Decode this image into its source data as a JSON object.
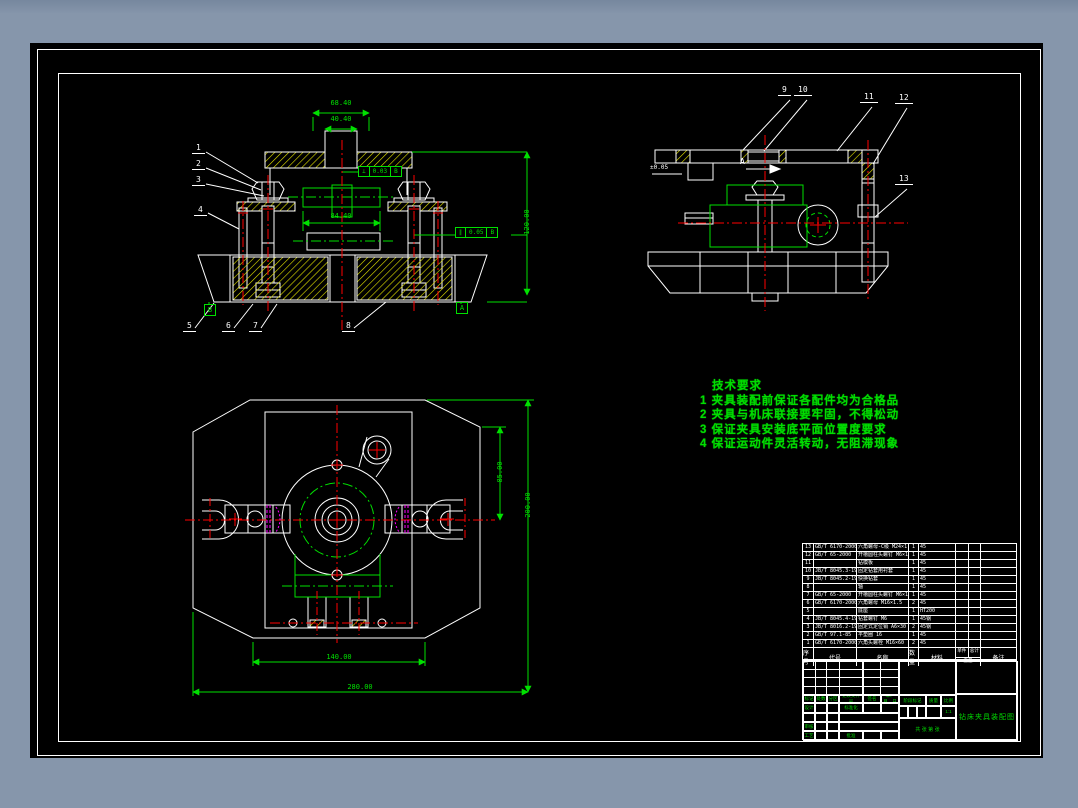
{
  "colors": {
    "background": "#8696ab",
    "paper": "#000000",
    "lines": "#ffffff",
    "dimensions": "#00e000",
    "centerlines": "#ff0000",
    "hatching": "#e6e600",
    "details": "#ff00ff"
  },
  "views": {
    "front": {
      "labels": [
        "1",
        "2",
        "3",
        "4",
        "5",
        "6",
        "7",
        "8"
      ],
      "dims": {
        "top_outer": "68.40",
        "top_inner": "40.40",
        "middle": "84.40",
        "right": "120.00"
      },
      "fcf1": {
        "symbol": "⊥",
        "value": "0.03",
        "datum": "B"
      },
      "fcf2": {
        "symbol": "∥",
        "value": "0.05",
        "datum": "B"
      },
      "datum_left": "B",
      "datum_right": "A"
    },
    "side": {
      "labels": [
        "9",
        "10",
        "11",
        "12",
        "13"
      ],
      "note": "±0.05",
      "section_arrow": "A"
    },
    "plan": {
      "dims": {
        "bottom_inner": "140.00",
        "bottom_outer": "280.00",
        "right_small": "85.00",
        "right_tall": "200.00"
      }
    }
  },
  "tech_req": {
    "title": "技术要求",
    "items": [
      "1 夹具装配前保证各配件均为合格品",
      "2 夹具与机床联接要牢固，不得松动",
      "3 保证夹具安装底平面位置度要求",
      "4 保证运动件灵活转动，无阻滞现象"
    ]
  },
  "bom": {
    "headers": {
      "no": "序号",
      "code": "代号",
      "name": "名称",
      "qty": "数量",
      "material": "材料",
      "unit": "单件",
      "total": "总计",
      "weight": "重量",
      "remark": "备注"
    },
    "rows": [
      [
        "13",
        "GB/T 6170-2000",
        "六角螺母-C级 M24×1.5",
        "1",
        "45",
        "",
        "",
        ""
      ],
      [
        "12",
        "GB/T 65-2000",
        "开槽圆柱头螺钉 M6×16",
        "1",
        "45",
        "",
        "",
        ""
      ],
      [
        "11",
        "",
        "钻模板",
        "1",
        "45",
        "",
        "",
        ""
      ],
      [
        "10",
        "JB/T 8045.3-1999",
        "固定钻套用衬套",
        "1",
        "45",
        "",
        "",
        ""
      ],
      [
        "9",
        "JB/T 8045.2-1999",
        "快换钻套",
        "1",
        "45",
        "",
        "",
        ""
      ],
      [
        "8",
        "",
        "轴",
        "1",
        "45",
        "",
        "",
        ""
      ],
      [
        "7",
        "GB/T 65-2000",
        "开槽圆柱头螺钉 M6×16",
        "1",
        "45",
        "",
        "",
        ""
      ],
      [
        "6",
        "GB/T 6170-2000",
        "六角螺母 M16×1.5",
        "2",
        "45",
        "",
        "",
        ""
      ],
      [
        "5",
        "",
        "底座",
        "1",
        "HT200",
        "",
        "",
        ""
      ],
      [
        "4",
        "JB/T 8045.4-1999",
        "钻套螺钉 M6",
        "1",
        "45钢",
        "",
        "",
        ""
      ],
      [
        "3",
        "JB/T 8016.2-1999",
        "固定式定位销 A6×30",
        "2",
        "45钢",
        "",
        "",
        ""
      ],
      [
        "2",
        "GB/T 97.1-85",
        "平垫圈 16",
        "1",
        "45",
        "",
        "",
        ""
      ],
      [
        "1",
        "GB/T 6170-2000",
        "六角头螺栓 M16×60",
        "2",
        "45",
        "",
        "",
        ""
      ]
    ]
  },
  "title_block": {
    "rev": [
      "标记",
      "处数",
      "分区",
      "更改文件号",
      "签名",
      "年、月、日"
    ],
    "roles": {
      "design": "设计",
      "standard": "标准化",
      "audit": "审核",
      "process": "工艺",
      "approve": "批准"
    },
    "stage_label": "阶段标记",
    "weight_label": "质量",
    "scale_label": "比例",
    "scale_value": "1:1",
    "sheet_info": "共 张 第 张",
    "title": "钻床夹具装配图"
  }
}
